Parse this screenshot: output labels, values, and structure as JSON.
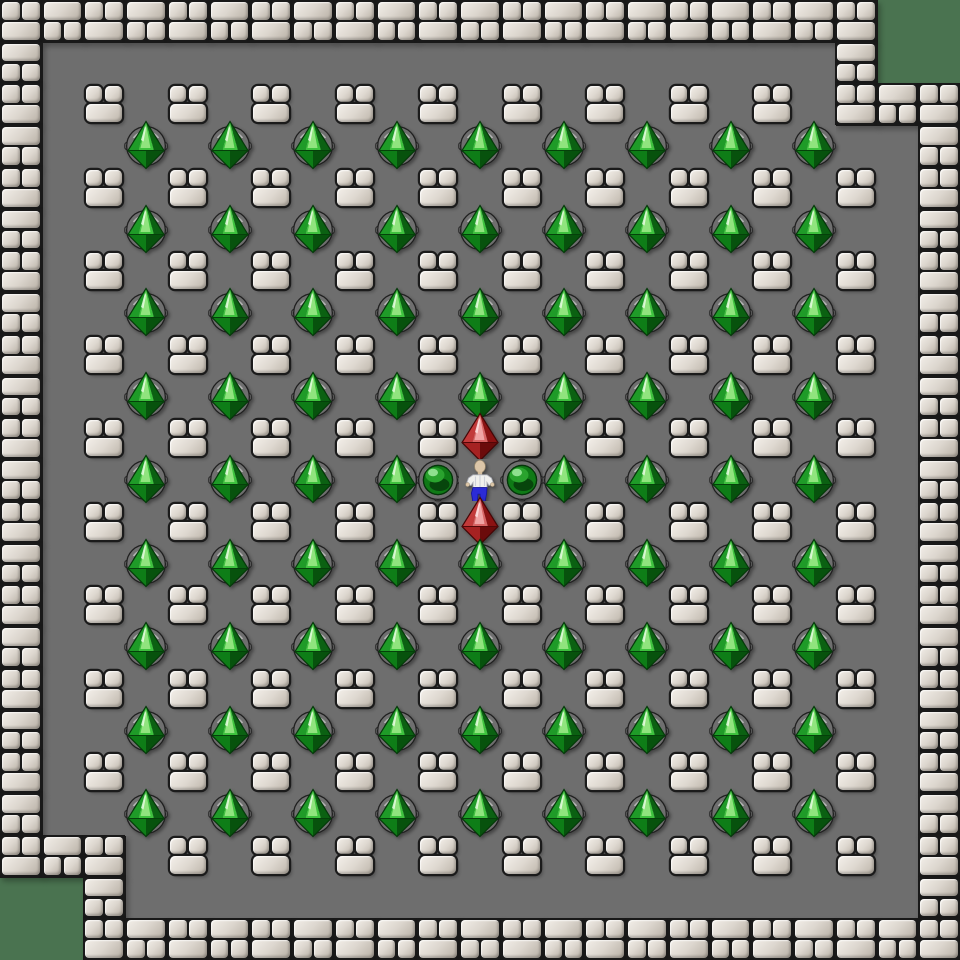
{
  "board": {
    "cols": 23,
    "rows": 23,
    "tile_px": 41.74,
    "width_px": 960,
    "height_px": 960,
    "legend": {
      "#": "wall-brick",
      "X": "wall-block",
      "-": "floor-tile",
      "_": "outside",
      "G": "emerald-on-socket",
      "R": "ruby-gem",
      "O": "ball-on-socket",
      "P": "player"
    },
    "map": [
      "#####################__",
      "#-------------------#__",
      "#-X-X-X-X-X-X-X-X-X-###",
      "#--G-G-G-G-G-G-G-G-G--#",
      "#-X-X-X-X-X-X-X-X-X-X-#",
      "#--G-G-G-G-G-G-G-G-G--#",
      "#-X-X-X-X-X-X-X-X-X-X-#",
      "#--G-G-G-G-G-G-G-G-G--#",
      "#-X-X-X-X-X-X-X-X-X-X-#",
      "#--G-G-G-G-G-G-G-G-G--#",
      "#-X-X-X-X-XRX-X-X-X-X-#",
      "#--G-G-G-GOPOG-G-G-G--#",
      "#-X-X-X-X-XRX-X-X-X-X-#",
      "#--G-G-G-G-G-G-G-G-G--#",
      "#-X-X-X-X-X-X-X-X-X-X-#",
      "#--G-G-G-G-G-G-G-G-G--#",
      "#-X-X-X-X-X-X-X-X-X-X-#",
      "#--G-G-G-G-G-G-G-G-G--#",
      "#-X-X-X-X-X-X-X-X-X-X-#",
      "#--G-G-G-G-G-G-G-G-G--#",
      "###-X-X-X-X-X-X-X-X-X-#",
      "__#-------------------#",
      "__#####################"
    ],
    "player": {
      "col": 11,
      "row": 11
    },
    "counts": {
      "emeralds_on_sockets": 80,
      "rubies": 2,
      "balls_on_sockets": 2,
      "isolated_wall_blocks": 98
    }
  },
  "palette": {
    "outside_green": "#4a7350",
    "floor_gray": "#6e6e6e",
    "mortar_dark": "#191919",
    "brick_light": "#f2eee8",
    "brick_base": "#dcd6ce",
    "brick_shadow": "#b7afa4",
    "socket_gray": "#6f6f6f",
    "socket_outline": "#1f1f1f",
    "emerald_bright": "#3ec23e",
    "emerald_pale": "#90e47e",
    "emerald_dark": "#0b6112",
    "ruby_bright": "#d96565",
    "ruby_pale": "#f0a4a4",
    "ruby_dark": "#8a1212",
    "ball_green": "#0f7a16",
    "ball_highlight": "#8fe08f",
    "player_skin": "#dcc6a8",
    "player_shirt": "#f0f0ed",
    "player_pants": "#2b2bd6"
  }
}
